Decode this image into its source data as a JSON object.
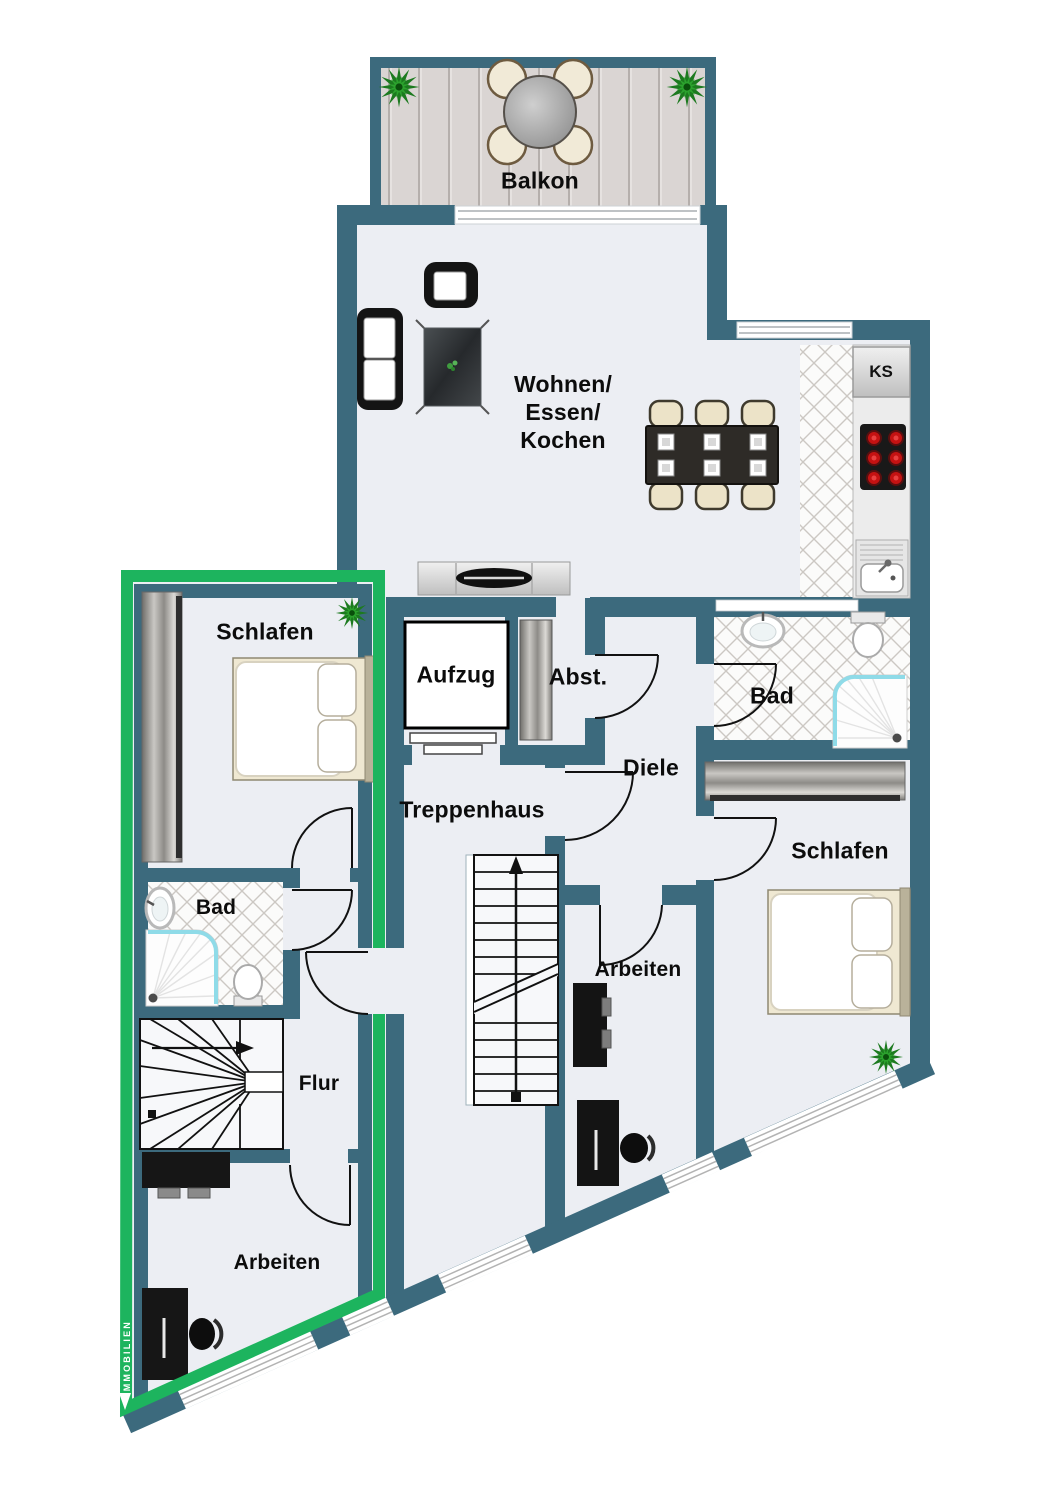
{
  "plan": {
    "watermark": "IMMOBILIEN",
    "rooms": {
      "balkon": {
        "label": "Balkon"
      },
      "wohnen": {
        "label_lines": [
          "Wohnen/",
          "Essen/",
          "Kochen"
        ]
      },
      "kuehlschrank": {
        "label": "KS"
      },
      "aufzug": {
        "label": "Aufzug"
      },
      "abstellraum": {
        "label": "Abst."
      },
      "diele": {
        "label": "Diele"
      },
      "treppenhaus": {
        "label": "Treppenhaus"
      },
      "bad_rechts": {
        "label": "Bad"
      },
      "bad_links": {
        "label": "Bad"
      },
      "schlafen_links": {
        "label": "Schlafen"
      },
      "schlafen_rechts": {
        "label": "Schlafen"
      },
      "arbeiten_links": {
        "label": "Arbeiten"
      },
      "arbeiten_mitte": {
        "label": "Arbeiten"
      },
      "flur": {
        "label": "Flur"
      }
    },
    "colors": {
      "wall": "#3c6a7d",
      "floor": "#eceef3",
      "highlight_green": "#1db45e",
      "deck": "#dad5d3",
      "tile_line": "#ccc8c3",
      "door_line": "#111111",
      "burner_red": "#c41212",
      "shower_glass": "#8fdbe8",
      "plant_green": "#1c7a1f"
    }
  }
}
